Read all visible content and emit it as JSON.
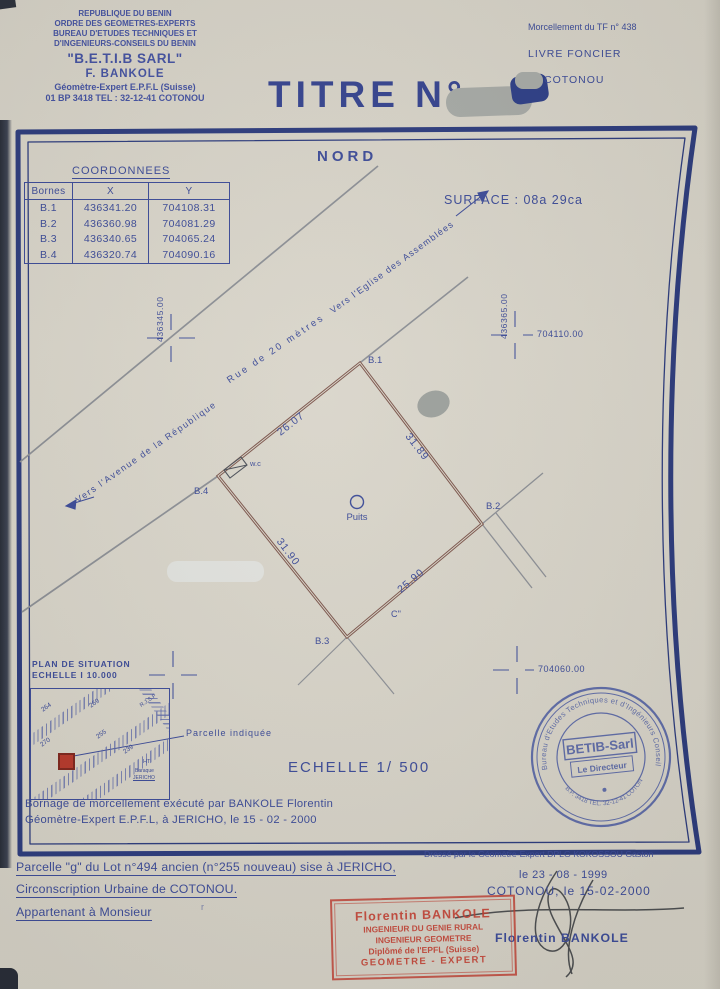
{
  "letterhead": {
    "line1": "REPUBLIQUE DU BENIN",
    "line2": "ORDRE DES GEOMETRES-EXPERTS",
    "line3": "BUREAU D'ETUDES TECHNIQUES ET",
    "line4": "D'INGENIEURS-CONSEILS DU BENIN",
    "firm": "\"B.E.T.I.B SARL\"",
    "name": "F. BANKOLE",
    "title": "Géomètre-Expert  E.P.F.L (Suisse)",
    "address": "01 BP 3418  TEL : 32-12-41  COTONOU"
  },
  "registry": {
    "morcellement": "Morcellement du TF n° 438",
    "livre": "LIVRE FONCIER",
    "ville": "COTONOU"
  },
  "title_block": {
    "titre": "TITRE  N°"
  },
  "map": {
    "north": "NORD",
    "surface": "SURFACE   :   08a 29ca",
    "coord_title": "COORDONNEES",
    "coord_headers": [
      "Bornes",
      "X",
      "Y"
    ],
    "coords": [
      [
        "B.1",
        "436341.20",
        "704108.31"
      ],
      [
        "B.2",
        "436360.98",
        "704081.29"
      ],
      [
        "B.3",
        "436340.65",
        "704065.24"
      ],
      [
        "B.4",
        "436320.74",
        "704090.16"
      ]
    ],
    "grid_x_left": "436345.00",
    "grid_x_right": "436365.00",
    "grid_y_top": "704110.00",
    "grid_y_bottom": "704060.00",
    "road_left": "Vers  l'Avenue  de  la  République",
    "road_mid": "Rue  de  20  mètres",
    "road_right": "Vers  l'Eglise  des  Assemblées",
    "b1": "B.1",
    "b2": "B.2",
    "b3": "B.3",
    "b4": "B.4",
    "d_b4b1": "26.07",
    "d_b1b2": "31.89",
    "d_b4b3": "31.90",
    "d_b3b2": "25.90",
    "wc": "w.c",
    "well": "Puits",
    "point_c": "C''",
    "scale": "ECHELLE  1/ 500"
  },
  "situation": {
    "title": "PLAN DE SITUATION",
    "scale": "ECHELLE   I   10.000",
    "p264": "264",
    "p269": "269",
    "p270": "270",
    "p255": "255",
    "p239": "239",
    "rjsf": "R.J.S.F",
    "ht": "HT",
    "baraque": "Baraque",
    "jericho": "JERICHO",
    "note": "Parcelle  indiquée"
  },
  "bornage": {
    "line1": "Bornage de morcellement exécuté par  BANKOLE  Florentin",
    "line2": "Géomètre-Expert  E.P.F.L,  à  JERICHO,  le 15 - 02 - 2000"
  },
  "blue_stamp": {
    "ring_top": "Bureau  d'Etudes  Techniques  et  d'Ingénieurs  Conseils  du  Bénin",
    "ring_bottom": "B.P. 3418  TEL. 32-12-41  COTONOU",
    "center": "BETIB-Sarl",
    "director": "Le Directeur"
  },
  "footer": {
    "line1": "Parcelle \"g\" du Lot n°494 ancien (n°255  nouveau)  sise  à  JERICHO,",
    "line2": "Circonscription  Urbaine  de  COTONOU.",
    "line3": "Appartenant  à  Monsieur",
    "mark": "r",
    "dresse": "Dressé par le Géomètre-Expert DPLG KOKOSSOU Gaston",
    "date1": "le  23 - 08 - 1999",
    "date2": "COTONOU, le 15-02-2000",
    "signer": "Florentin  BANKOLE"
  },
  "red_stamp": {
    "l1": "Florentin  BANKOLE",
    "l2": "INGENIEUR  DU  GENIE  RURAL",
    "l3": "INGENIEUR  GEOMETRE",
    "l4": "Diplômé  de  l'EPFL  (Suisse)",
    "l5": "GEOMETRE  -  EXPERT"
  }
}
